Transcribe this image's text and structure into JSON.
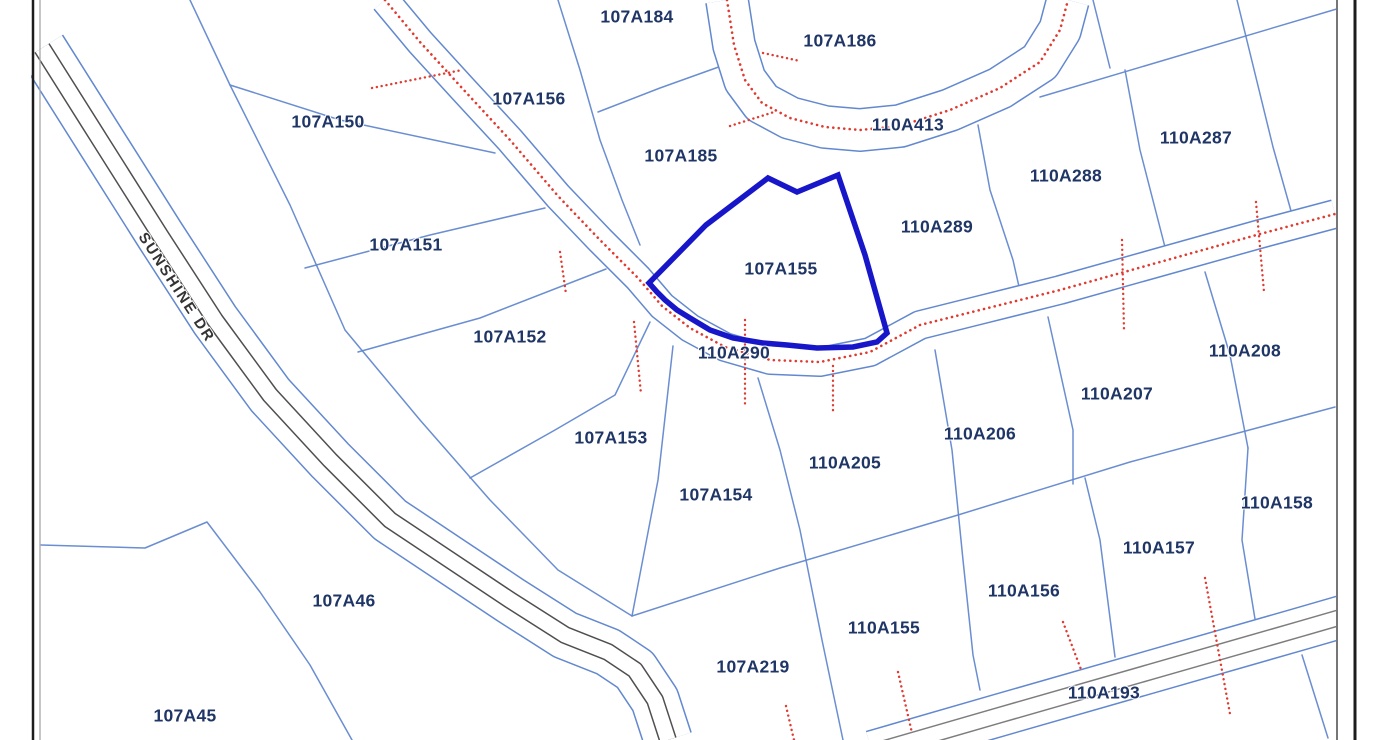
{
  "map": {
    "width": 1383,
    "height": 740,
    "colors": {
      "background": "#ffffff",
      "parcel_line": "#6288cf",
      "road_edge": "#6288cf",
      "highlight": "#1717c9",
      "label": "#1e3566",
      "road_name_color": "#333333",
      "red": "#e03b30",
      "pavement_dark": "#4f4f4f",
      "pavement_light": "#7d7d7d",
      "border_dark": "#1c1c1c",
      "border_gray": "#a8a8a8"
    },
    "highlight_parcel": {
      "id": "107A155",
      "points": [
        [
          768,
          178
        ],
        [
          797,
          192
        ],
        [
          838,
          175
        ],
        [
          865,
          255
        ],
        [
          887,
          333
        ],
        [
          877,
          342
        ],
        [
          853,
          347
        ],
        [
          817,
          348
        ],
        [
          787,
          345
        ],
        [
          763,
          343
        ],
        [
          733,
          338
        ],
        [
          710,
          330
        ],
        [
          690,
          318
        ],
        [
          677,
          310
        ],
        [
          665,
          300
        ],
        [
          657,
          292
        ],
        [
          649,
          283
        ],
        [
          706,
          225
        ]
      ]
    },
    "labels": [
      {
        "text": "107A184",
        "x": 637,
        "y": 18
      },
      {
        "text": "107A186",
        "x": 840,
        "y": 42
      },
      {
        "text": "107A156",
        "x": 529,
        "y": 100
      },
      {
        "text": "110A413",
        "x": 908,
        "y": 126
      },
      {
        "text": "110A287",
        "x": 1196,
        "y": 139
      },
      {
        "text": "107A150",
        "x": 328,
        "y": 123
      },
      {
        "text": "107A185",
        "x": 681,
        "y": 157
      },
      {
        "text": "110A288",
        "x": 1066,
        "y": 177
      },
      {
        "text": "110A289",
        "x": 937,
        "y": 228
      },
      {
        "text": "107A151",
        "x": 406,
        "y": 246
      },
      {
        "text": "107A155",
        "x": 781,
        "y": 270
      },
      {
        "text": "107A152",
        "x": 510,
        "y": 338
      },
      {
        "text": "110A290",
        "x": 734,
        "y": 354
      },
      {
        "text": "110A208",
        "x": 1245,
        "y": 352
      },
      {
        "text": "110A207",
        "x": 1117,
        "y": 395
      },
      {
        "text": "110A206",
        "x": 980,
        "y": 435
      },
      {
        "text": "107A153",
        "x": 611,
        "y": 439
      },
      {
        "text": "110A205",
        "x": 845,
        "y": 464
      },
      {
        "text": "107A154",
        "x": 716,
        "y": 496
      },
      {
        "text": "110A158",
        "x": 1277,
        "y": 504
      },
      {
        "text": "110A157",
        "x": 1159,
        "y": 549
      },
      {
        "text": "110A156",
        "x": 1024,
        "y": 592
      },
      {
        "text": "107A46",
        "x": 344,
        "y": 602
      },
      {
        "text": "110A155",
        "x": 884,
        "y": 629
      },
      {
        "text": "107A219",
        "x": 753,
        "y": 668
      },
      {
        "text": "110A193",
        "x": 1104,
        "y": 694
      },
      {
        "text": "107A45",
        "x": 185,
        "y": 717
      }
    ],
    "road_name": {
      "text": "SUNSHINE DR",
      "x": 176,
      "y": 288,
      "rotate": 57
    },
    "roads": [
      {
        "name": "sunshine-dr-road",
        "center": [
          [
            42,
            48
          ],
          [
            100,
            140
          ],
          [
            160,
            235
          ],
          [
            215,
            320
          ],
          [
            270,
            395
          ],
          [
            330,
            460
          ],
          [
            390,
            520
          ],
          [
            450,
            560
          ],
          [
            510,
            600
          ],
          [
            565,
            635
          ],
          [
            608,
            652
          ],
          [
            635,
            670
          ],
          [
            655,
            700
          ],
          [
            668,
            740
          ]
        ],
        "row": 50,
        "pavement": 18,
        "red_center": false,
        "pavement_shade": "dark"
      },
      {
        "name": "nw-curve-road-110A290",
        "center": [
          [
            385,
            0
          ],
          [
            420,
            42
          ],
          [
            462,
            88
          ],
          [
            510,
            140
          ],
          [
            558,
            196
          ],
          [
            600,
            240
          ],
          [
            638,
            278
          ],
          [
            662,
            306
          ],
          [
            690,
            328
          ],
          [
            725,
            347
          ],
          [
            770,
            360
          ],
          [
            820,
            362
          ],
          [
            870,
            352
          ],
          [
            920,
            325
          ],
          [
            980,
            310
          ],
          [
            1060,
            290
          ],
          [
            1160,
            262
          ],
          [
            1260,
            234
          ],
          [
            1335,
            214
          ]
        ],
        "row": 30,
        "pavement": 0,
        "red_center": true
      },
      {
        "name": "top-road-110A413",
        "center": [
          [
            727,
            0
          ],
          [
            734,
            45
          ],
          [
            745,
            80
          ],
          [
            762,
            103
          ],
          [
            790,
            118
          ],
          [
            825,
            127
          ],
          [
            860,
            130
          ],
          [
            900,
            126
          ],
          [
            950,
            110
          ],
          [
            1000,
            88
          ],
          [
            1040,
            62
          ],
          [
            1060,
            30
          ],
          [
            1068,
            0
          ]
        ],
        "row": 44,
        "pavement": 0,
        "red_center": true
      },
      {
        "name": "bottom-right-road-110A193",
        "center": [
          [
            872,
            752
          ],
          [
            1000,
            715
          ],
          [
            1150,
            672
          ],
          [
            1300,
            629
          ],
          [
            1383,
            605
          ]
        ],
        "row": 44,
        "pavement": 17,
        "red_center": false,
        "pavement_shade": "light"
      }
    ],
    "parcel_lines": [
      [
        [
          1040,
          97
        ],
        [
          1340,
          8
        ]
      ],
      [
        [
          1093,
          0
        ],
        [
          1110,
          68
        ]
      ],
      [
        [
          1125,
          70
        ],
        [
          1140,
          150
        ],
        [
          1166,
          251
        ]
      ],
      [
        [
          1237,
          0
        ],
        [
          1273,
          147
        ],
        [
          1293,
          218
        ]
      ],
      [
        [
          978,
          125
        ],
        [
          990,
          190
        ],
        [
          1013,
          260
        ],
        [
          1022,
          300
        ]
      ],
      [
        [
          558,
          0
        ],
        [
          580,
          70
        ],
        [
          600,
          140
        ],
        [
          622,
          200
        ],
        [
          640,
          245
        ]
      ],
      [
        [
          598,
          112
        ],
        [
          660,
          88
        ],
        [
          727,
          64
        ]
      ],
      [
        [
          190,
          0
        ],
        [
          230,
          85
        ],
        [
          290,
          205
        ],
        [
          345,
          330
        ],
        [
          420,
          420
        ],
        [
          490,
          500
        ],
        [
          558,
          570
        ],
        [
          632,
          616
        ]
      ],
      [
        [
          230,
          85
        ],
        [
          340,
          120
        ],
        [
          495,
          153
        ]
      ],
      [
        [
          305,
          268
        ],
        [
          430,
          235
        ],
        [
          545,
          208
        ]
      ],
      [
        [
          358,
          352
        ],
        [
          480,
          318
        ],
        [
          606,
          269
        ]
      ],
      [
        [
          470,
          478
        ],
        [
          555,
          430
        ],
        [
          615,
          395
        ],
        [
          650,
          322
        ]
      ],
      [
        [
          632,
          616
        ],
        [
          658,
          480
        ],
        [
          673,
          346
        ]
      ],
      [
        [
          632,
          616
        ],
        [
          780,
          568
        ],
        [
          958,
          515
        ],
        [
          1130,
          462
        ],
        [
          1335,
          407
        ]
      ],
      [
        [
          758,
          378
        ],
        [
          780,
          450
        ],
        [
          800,
          530
        ],
        [
          822,
          640
        ],
        [
          843,
          740
        ]
      ],
      [
        [
          935,
          350
        ],
        [
          952,
          450
        ],
        [
          963,
          560
        ],
        [
          973,
          655
        ],
        [
          980,
          690
        ]
      ],
      [
        [
          1205,
          272
        ],
        [
          1230,
          355
        ],
        [
          1248,
          448
        ]
      ],
      [
        [
          1248,
          448
        ],
        [
          1242,
          540
        ],
        [
          1255,
          619
        ]
      ],
      [
        [
          1048,
          317
        ],
        [
          1073,
          430
        ],
        [
          1073,
          484
        ]
      ],
      [
        [
          1085,
          478
        ],
        [
          1100,
          540
        ],
        [
          1115,
          657
        ]
      ],
      [
        [
          41,
          545
        ],
        [
          145,
          548
        ],
        [
          207,
          522
        ],
        [
          260,
          592
        ],
        [
          310,
          665
        ],
        [
          352,
          740
        ]
      ],
      [
        [
          1302,
          655
        ],
        [
          1328,
          738
        ]
      ]
    ],
    "red_ticks": [
      [
        [
          372,
          88
        ],
        [
          462,
          70
        ]
      ],
      [
        [
          560,
          252
        ],
        [
          566,
          294
        ]
      ],
      [
        [
          634,
          322
        ],
        [
          641,
          394
        ]
      ],
      [
        [
          745,
          320
        ],
        [
          745,
          406
        ]
      ],
      [
        [
          833,
          366
        ],
        [
          833,
          414
        ]
      ],
      [
        [
          1122,
          240
        ],
        [
          1124,
          330
        ]
      ],
      [
        [
          1256,
          202
        ],
        [
          1264,
          292
        ]
      ],
      [
        [
          730,
          126
        ],
        [
          774,
          112
        ]
      ],
      [
        [
          763,
          53
        ],
        [
          800,
          61
        ]
      ],
      [
        [
          1205,
          578
        ],
        [
          1230,
          714
        ]
      ],
      [
        [
          786,
          706
        ],
        [
          794,
          740
        ]
      ],
      [
        [
          1063,
          622
        ],
        [
          1082,
          672
        ]
      ],
      [
        [
          898,
          672
        ],
        [
          912,
          733
        ]
      ]
    ],
    "border": {
      "left_dark_x": 33,
      "left_gray_x": 40,
      "right_thin_x": 1337,
      "right_thick_x": 1355
    }
  }
}
